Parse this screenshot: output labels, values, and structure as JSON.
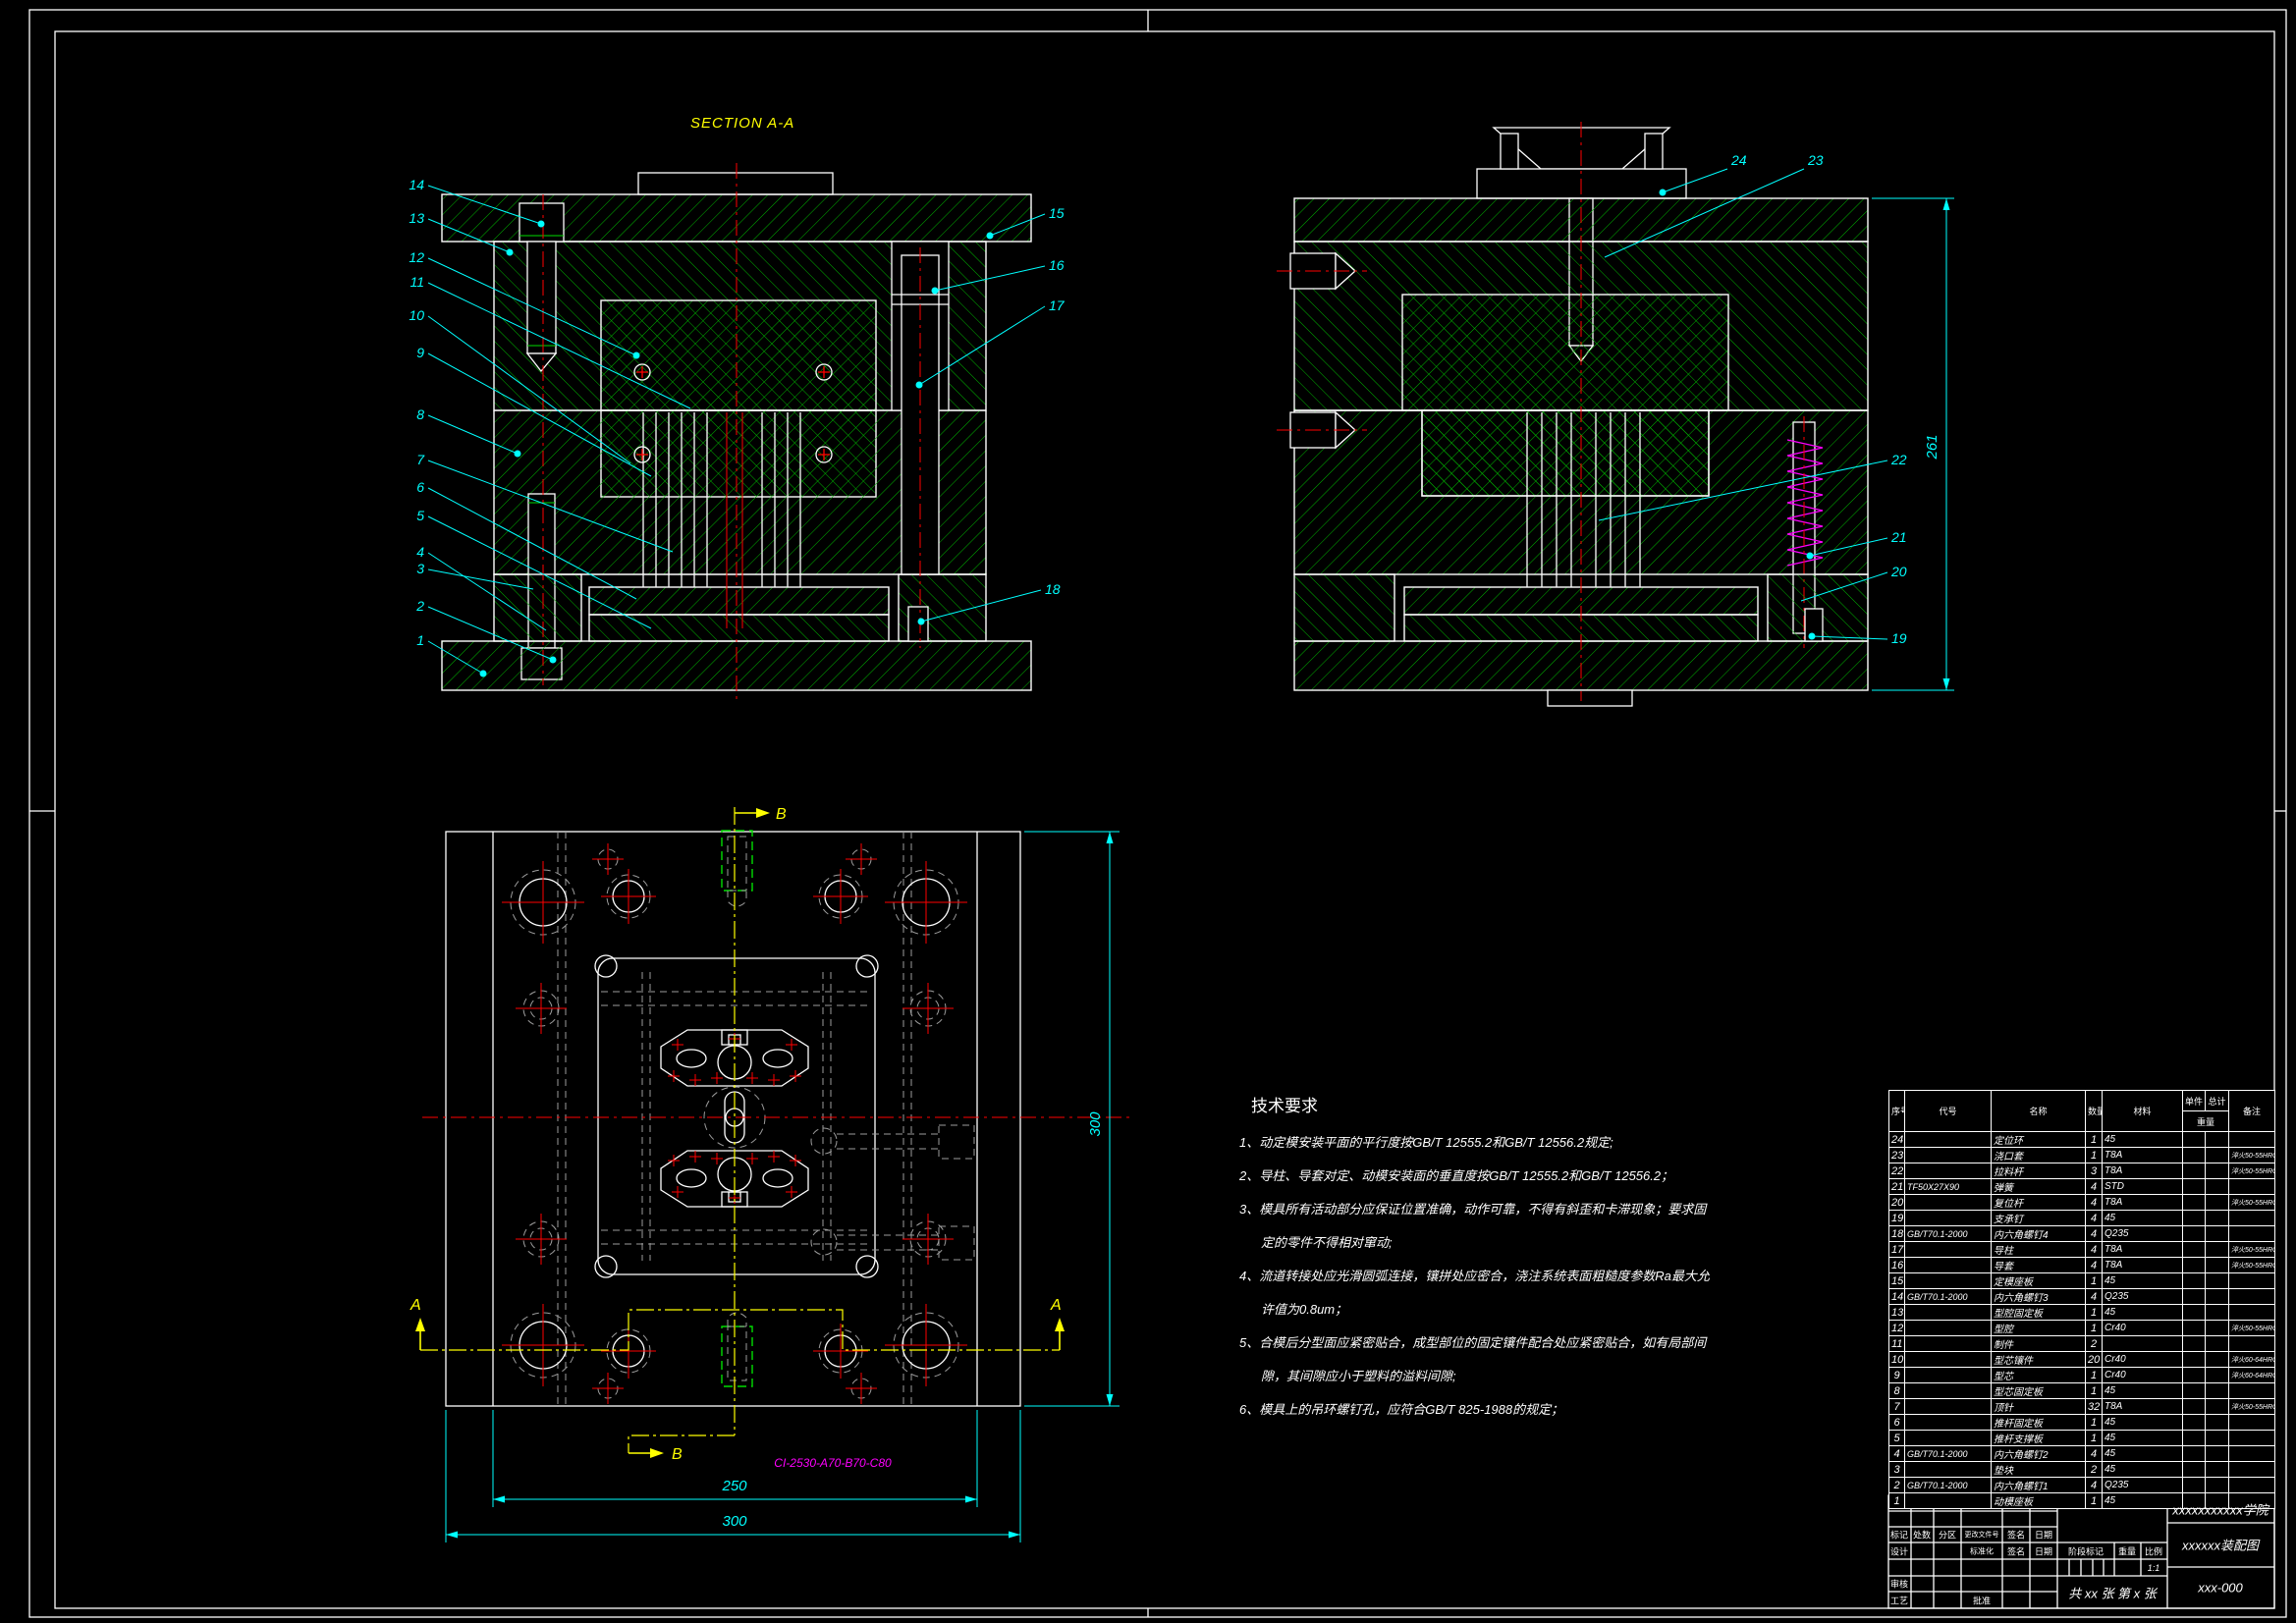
{
  "colors": {
    "background": "#000000",
    "outline": "#ffffff",
    "hatch_green": "#00b400",
    "centerline_red": "#ff0000",
    "annotation_cyan": "#00ffff",
    "section_yellow": "#ffff00",
    "mold_code_magenta": "#ff00ff",
    "hidden_gray": "#9c9c9c"
  },
  "labels": {
    "section_a": "SECTION A-A",
    "section_b": "SECTION B-B",
    "cut_a": "A",
    "cut_b": "B",
    "mold_base_code": "CI-2530-A70-B70-C80"
  },
  "dimensions": {
    "plan_outer_width": "300",
    "plan_cavity_width": "250",
    "plan_height": "300",
    "section_b_stack_height": "261"
  },
  "balloons": {
    "a_left": [
      "14",
      "13",
      "12",
      "11",
      "10",
      "9",
      "8",
      "7",
      "6",
      "5",
      "4",
      "3",
      "2",
      "1"
    ],
    "a_right": [
      "15",
      "16",
      "17",
      "18"
    ],
    "b_top": [
      "24",
      "23"
    ],
    "b_right": [
      "22",
      "21",
      "20",
      "19"
    ]
  },
  "tech_requirements": {
    "title": "技术要求",
    "items": [
      "1、动定模安装平面的平行度按GB/T 12555.2和GB/T 12556.2规定;",
      "2、导柱、导套对定、动模安装面的垂直度按GB/T 12555.2和GB/T 12556.2；",
      "3、模具所有活动部分应保证位置准确，动作可靠，不得有斜歪和卡滞现象；要求固定的零件不得相对窜动;",
      "4、流道转接处应光滑圆弧连接，镶拼处应密合，浇注系统表面粗糙度参数Ra最大允许值为0.8um；",
      "5、合模后分型面应紧密贴合，成型部位的固定镶件配合处应紧密贴合，如有局部间隙，其间隙应小于塑料的溢料间隙;",
      "6、模具上的吊环螺钉孔，应符合GB/T 825-1988的规定；"
    ]
  },
  "parts_table": {
    "headers": {
      "no": "序号",
      "code": "代号",
      "name": "名称",
      "qty": "数量",
      "material": "材料",
      "unit": "单件",
      "total": "总计",
      "weight": "重量",
      "remark": "备注"
    },
    "rows": [
      {
        "no": "24",
        "code": "",
        "name": "定位环",
        "qty": "1",
        "material": "45",
        "remark": ""
      },
      {
        "no": "23",
        "code": "",
        "name": "浇口套",
        "qty": "1",
        "material": "T8A",
        "remark": "淬火50-55HRC"
      },
      {
        "no": "22",
        "code": "",
        "name": "拉料杆",
        "qty": "3",
        "material": "T8A",
        "remark": "淬火50-55HRC"
      },
      {
        "no": "21",
        "code": "TF50X27X90",
        "name": "弹簧",
        "qty": "4",
        "material": "STD",
        "remark": ""
      },
      {
        "no": "20",
        "code": "",
        "name": "复位杆",
        "qty": "4",
        "material": "T8A",
        "remark": "淬火50-55HRC"
      },
      {
        "no": "19",
        "code": "",
        "name": "支承钉",
        "qty": "4",
        "material": "45",
        "remark": ""
      },
      {
        "no": "18",
        "code": "GB/T70.1-2000",
        "name": "内六角螺钉4",
        "qty": "4",
        "material": "Q235",
        "remark": ""
      },
      {
        "no": "17",
        "code": "",
        "name": "导柱",
        "qty": "4",
        "material": "T8A",
        "remark": "淬火50-55HRC"
      },
      {
        "no": "16",
        "code": "",
        "name": "导套",
        "qty": "4",
        "material": "T8A",
        "remark": "淬火50-55HRC"
      },
      {
        "no": "15",
        "code": "",
        "name": "定模座板",
        "qty": "1",
        "material": "45",
        "remark": ""
      },
      {
        "no": "14",
        "code": "GB/T70.1-2000",
        "name": "内六角螺钉3",
        "qty": "4",
        "material": "Q235",
        "remark": ""
      },
      {
        "no": "13",
        "code": "",
        "name": "型腔固定板",
        "qty": "1",
        "material": "45",
        "remark": ""
      },
      {
        "no": "12",
        "code": "",
        "name": "型腔",
        "qty": "1",
        "material": "Cr40",
        "remark": "淬火50-55HRC"
      },
      {
        "no": "11",
        "code": "",
        "name": "制件",
        "qty": "2",
        "material": "",
        "remark": ""
      },
      {
        "no": "10",
        "code": "",
        "name": "型芯镶件",
        "qty": "20",
        "material": "Cr40",
        "remark": "淬火60-64HRC"
      },
      {
        "no": "9",
        "code": "",
        "name": "型芯",
        "qty": "1",
        "material": "Cr40",
        "remark": "淬火60-64HRC"
      },
      {
        "no": "8",
        "code": "",
        "name": "型芯固定板",
        "qty": "1",
        "material": "45",
        "remark": ""
      },
      {
        "no": "7",
        "code": "",
        "name": "顶针",
        "qty": "32",
        "material": "T8A",
        "remark": "淬火50-55HRC"
      },
      {
        "no": "6",
        "code": "",
        "name": "推杆固定板",
        "qty": "1",
        "material": "45",
        "remark": ""
      },
      {
        "no": "5",
        "code": "",
        "name": "推杆支撑板",
        "qty": "1",
        "material": "45",
        "remark": ""
      },
      {
        "no": "4",
        "code": "GB/T70.1-2000",
        "name": "内六角螺钉2",
        "qty": "4",
        "material": "45",
        "remark": ""
      },
      {
        "no": "3",
        "code": "",
        "name": "垫块",
        "qty": "2",
        "material": "45",
        "remark": ""
      },
      {
        "no": "2",
        "code": "GB/T70.1-2000",
        "name": "内六角螺钉1",
        "qty": "4",
        "material": "Q235",
        "remark": ""
      },
      {
        "no": "1",
        "code": "",
        "name": "动模座板",
        "qty": "1",
        "material": "45",
        "remark": ""
      }
    ]
  },
  "title_block": {
    "school": "xxxxxxxxxxx学院",
    "drawing_title": "xxxxxx装配图",
    "drawing_no": "xxx-000",
    "scale_value": "1:1",
    "sheet_note": "共 xx 张  第 x 张",
    "labels": {
      "mark": "标记",
      "count": "处数",
      "zone": "分区",
      "change_file": "更改文件号",
      "sign": "签名",
      "date": "日期",
      "design": "设计",
      "standardize": "标准化",
      "check": "审核",
      "process": "工艺",
      "approve": "批准",
      "stage_mark": "阶段标记",
      "weight": "重量",
      "scale": "比例"
    }
  }
}
